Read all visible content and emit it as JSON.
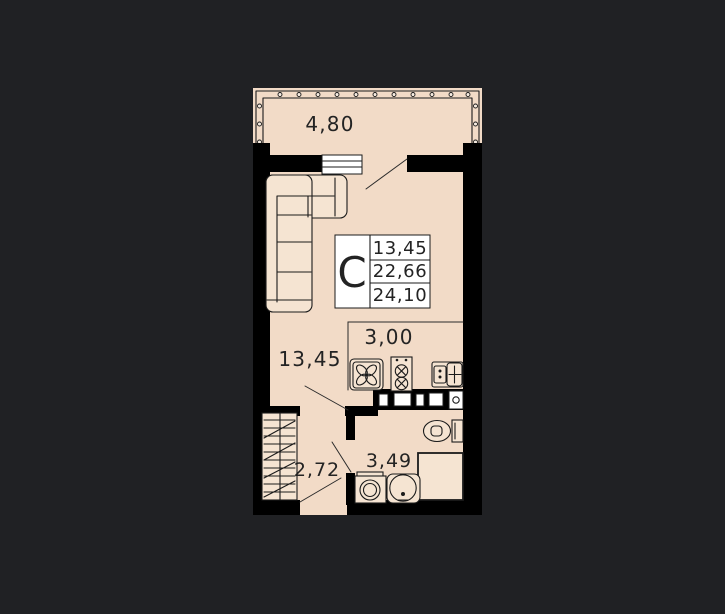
{
  "info_box": {
    "type_letter": "С",
    "rows": [
      {
        "value": "13,45"
      },
      {
        "value": "22,66"
      },
      {
        "value": "24,10"
      }
    ]
  },
  "rooms": {
    "balcony": {
      "label": "4,80"
    },
    "living": {
      "label": "13,45"
    },
    "kitchen": {
      "label": "3,00"
    },
    "hallway": {
      "label": "2,72"
    },
    "bathroom": {
      "label": "3,49"
    }
  },
  "icons": [
    "vent-fan-icon",
    "hob-flower-icon",
    "stove-burners-icon",
    "kitchen-sink-icon",
    "toilet-icon",
    "shower-tray-icon",
    "washbasin-icon",
    "washing-machine-icon",
    "sofa-icon",
    "wardrobe-icon"
  ],
  "colors": {
    "background": "#202124",
    "floor": "#f2dbc7",
    "walls": "#000000",
    "info_box_fill": "#ffffff",
    "text": "#232323"
  }
}
